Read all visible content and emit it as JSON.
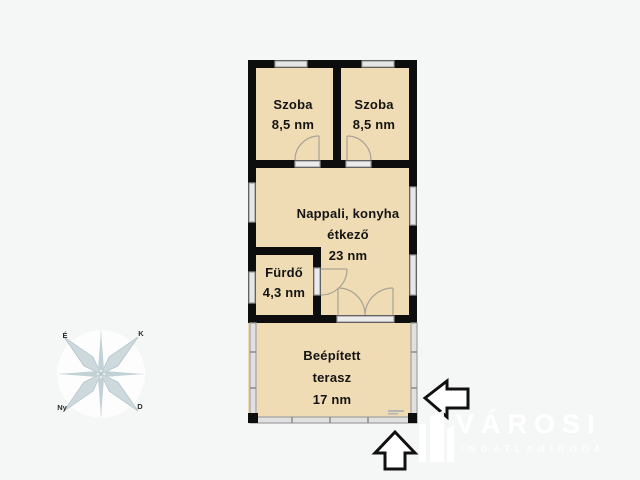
{
  "floorplan": {
    "rooms": [
      {
        "name": "Szoba",
        "area": "8,5 nm"
      },
      {
        "name": "Szoba",
        "area": "8,5 nm"
      },
      {
        "name": "Nappali, konyha",
        "name2": "étkező",
        "area": "23 nm"
      },
      {
        "name": "Fürdő",
        "area": "4,3 nm"
      },
      {
        "name": "Beépített",
        "name2": "terasz",
        "area": "17 nm"
      }
    ],
    "colors": {
      "floor": "#f0dcb4",
      "wall": "#0d0d0d",
      "window_fill": "#e6e6e6",
      "window_frame": "#9b9b9b",
      "door_arc": "#a8a296",
      "terrace_wall_fill": "#e0e0e0",
      "terrace_wall_frame": "#a0a0a0",
      "background": "#f5f6f6",
      "compass": "#c2d1d6"
    }
  },
  "compass": {
    "north_label": "É",
    "east_label": "K",
    "west_label": "Ny",
    "south_label": "D"
  },
  "watermark": {
    "brand": "VÁROSI",
    "subtitle": "INGATLANIRODA"
  },
  "icons": {
    "left_arrow": "left-arrow-icon",
    "up_arrow": "up-arrow-icon",
    "compass_rose": "compass-rose-icon",
    "building_logo": "building-logo-icon"
  }
}
